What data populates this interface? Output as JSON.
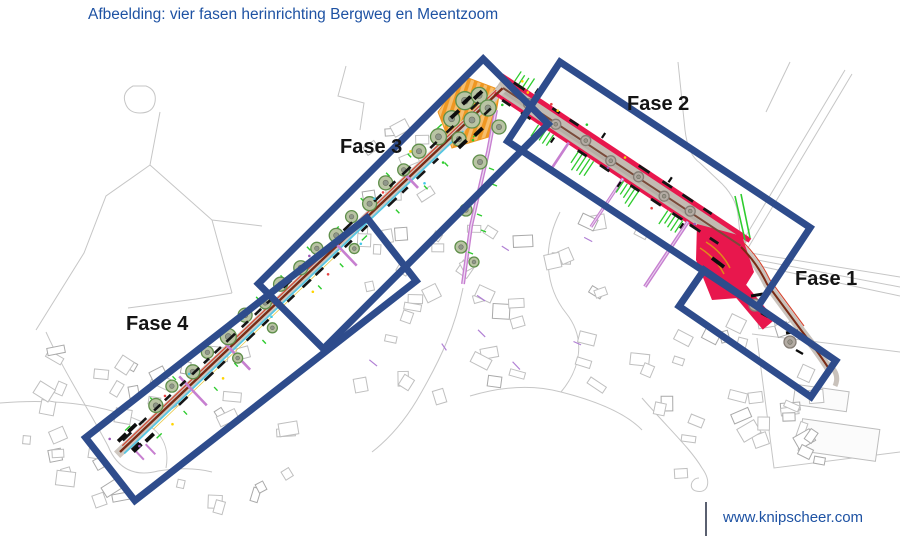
{
  "title": "Afbeelding: vier fasen herinrichting Bergweg en Meentzoom",
  "footer": {
    "url": "www.knipscheer.com"
  },
  "map": {
    "phases": [
      {
        "id": "fase-1",
        "label": "Fase 1"
      },
      {
        "id": "fase-2",
        "label": "Fase 2"
      },
      {
        "id": "fase-3",
        "label": "Fase 3"
      },
      {
        "id": "fase-4",
        "label": "Fase 4"
      }
    ],
    "colors": {
      "phase_box_navy": "#2e4c8c",
      "highlight_red": "#e8174d",
      "construction_orange": "#ef9722",
      "construction_orange_light": "#f6be6e",
      "tree_green": "#5f8f4a",
      "tree_fill": "#b9c4a4",
      "marking_green": "#2ecc2e",
      "utility_magenta": "#c77fd0",
      "road_brown": "#7a2b15",
      "water_cyan": "#55c6e2",
      "base_map_gray": "#c6c6c6",
      "title_blue": "#1e52a3",
      "label_black": "#141414"
    }
  }
}
